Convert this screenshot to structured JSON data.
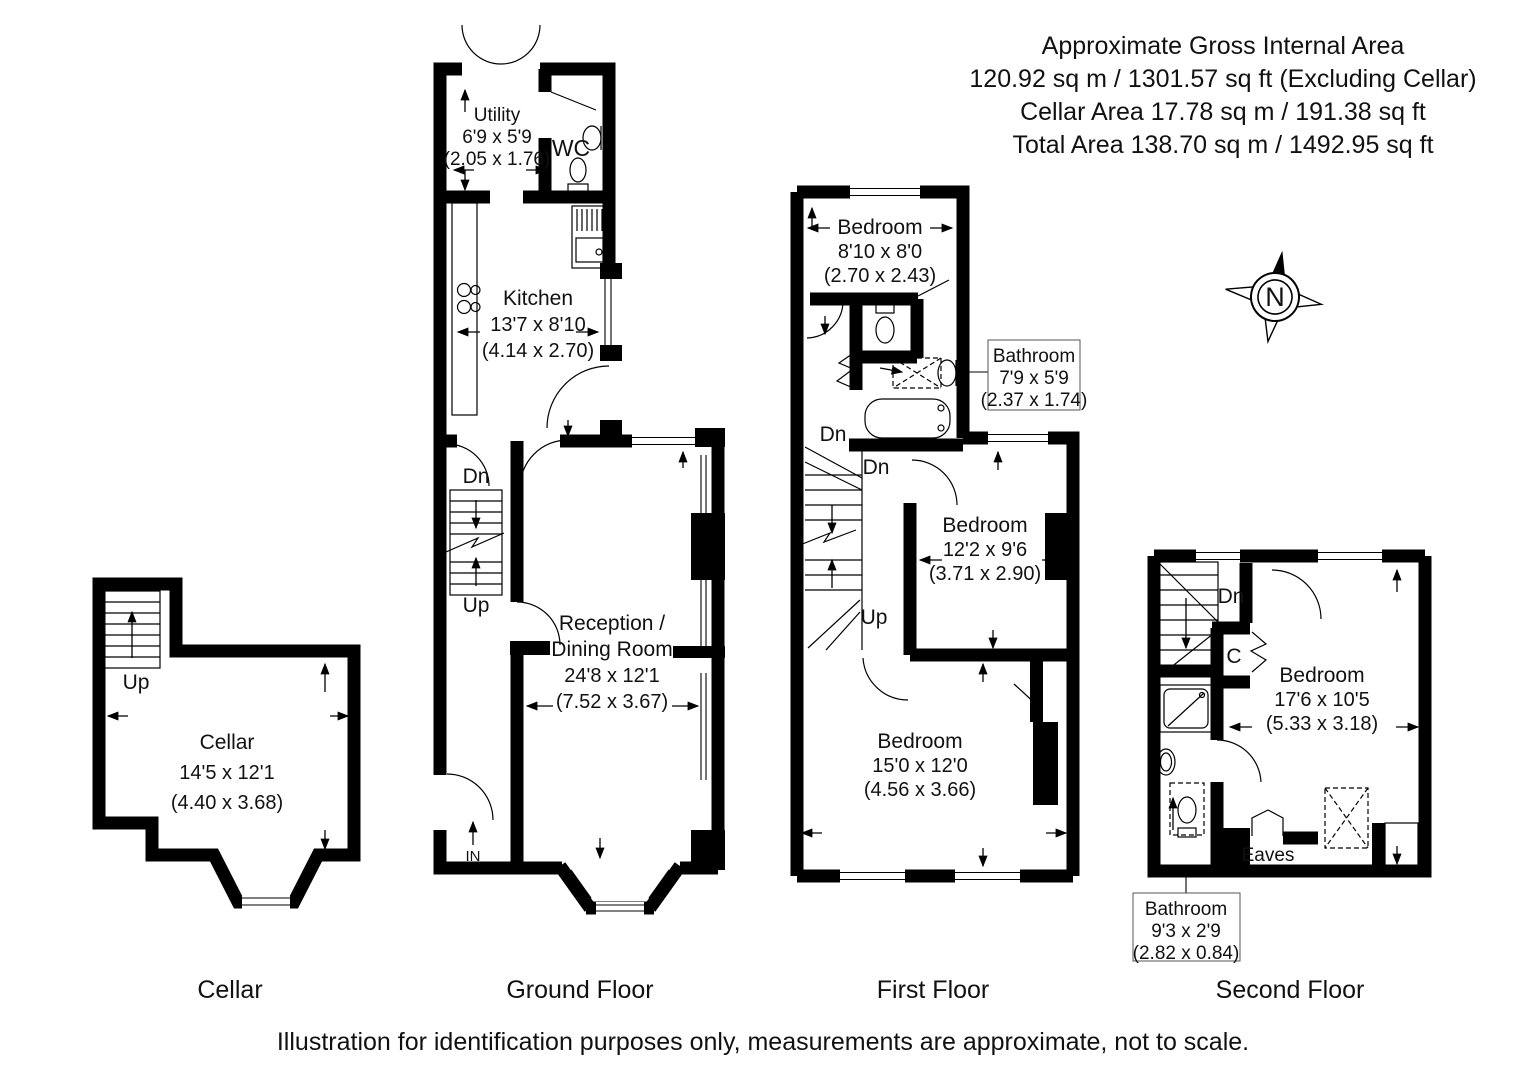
{
  "header": {
    "line1": "Approximate Gross Internal Area",
    "line2": "120.92 sq m / 1301.57 sq ft (Excluding Cellar)",
    "line3": "Cellar Area 17.78 sq m / 191.38 sq ft",
    "line4": "Total Area 138.70 sq m / 1492.95 sq ft"
  },
  "compass": {
    "north_label": "N"
  },
  "floors": {
    "cellar": {
      "caption": "Cellar",
      "room": {
        "name": "Cellar",
        "imperial": "14'5 x 12'1",
        "metric": "(4.40 x 3.68)"
      },
      "stair_up": "Up"
    },
    "ground": {
      "caption": "Ground Floor",
      "utility": {
        "name": "Utility",
        "imperial": "6'9 x 5'9",
        "metric": "(2.05 x 1.76)"
      },
      "wc": {
        "name": "WC"
      },
      "kitchen": {
        "name": "Kitchen",
        "imperial": "13'7 x 8'10",
        "metric": "(4.14 x 2.70)"
      },
      "reception": {
        "name_line1": "Reception /",
        "name_line2": "Dining Room",
        "imperial": "24'8 x 12'1",
        "metric": "(7.52 x 3.67)"
      },
      "stair_dn": "Dn",
      "stair_up": "Up",
      "entrance": "IN"
    },
    "first": {
      "caption": "First Floor",
      "bedroom1": {
        "name": "Bedroom",
        "imperial": "8'10 x 8'0",
        "metric": "(2.70 x 2.43)"
      },
      "bathroom_callout": {
        "name": "Bathroom",
        "imperial": "7'9 x 5'9",
        "metric": "(2.37 x 1.74)"
      },
      "bedroom2": {
        "name": "Bedroom",
        "imperial": "12'2 x 9'6",
        "metric": "(3.71 x 2.90)"
      },
      "bedroom3": {
        "name": "Bedroom",
        "imperial": "15'0 x 12'0",
        "metric": "(4.56 x 3.66)"
      },
      "stair_dn_upper": "Dn",
      "stair_dn": "Dn",
      "stair_up": "Up"
    },
    "second": {
      "caption": "Second Floor",
      "bedroom": {
        "name": "Bedroom",
        "imperial": "17'6 x 10'5",
        "metric": "(5.33 x 3.18)"
      },
      "bathroom_callout": {
        "name": "Bathroom",
        "imperial": "9'3 x 2'9",
        "metric": "(2.82 x 0.84)"
      },
      "stair_dn": "Dn",
      "closet": "C",
      "eaves": "Eaves"
    }
  },
  "footer": "Illustration for identification purposes only, measurements are approximate, not to scale."
}
